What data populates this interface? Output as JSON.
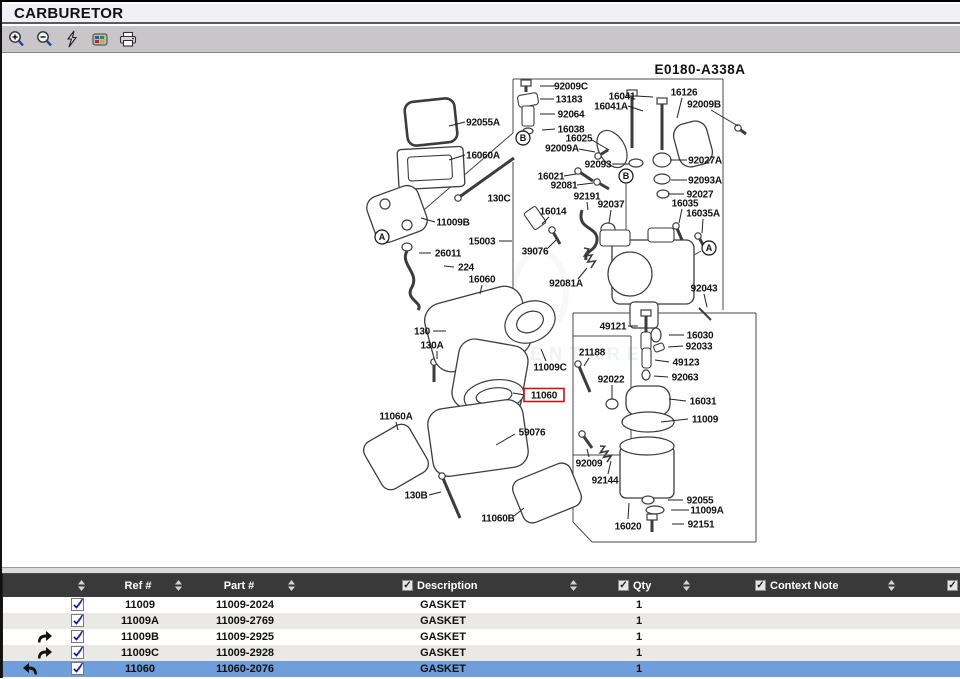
{
  "window": {
    "title": "CARBURETOR"
  },
  "toolbar": {
    "icons": [
      {
        "name": "zoom-in"
      },
      {
        "name": "zoom-out"
      },
      {
        "name": "flash"
      },
      {
        "name": "hotspot-parts"
      },
      {
        "name": "print"
      }
    ]
  },
  "colors": {
    "selected_row": "#6f9edb",
    "table_header_bg": "#3a393a",
    "row_alt": "#eae9e5",
    "toolbar_bg": "#c9c6c9",
    "titlebar_bg": "#f1f0f5",
    "highlight_red": "#cc1111"
  },
  "diagram": {
    "code": "E0180-A338A",
    "code_pos": [
      700,
      68
    ],
    "watermark": "LEADVENTURE",
    "highlighted_part": "11060",
    "callouts": [
      {
        "letter": "B",
        "x": 523,
        "y": 136
      },
      {
        "letter": "B",
        "x": 626,
        "y": 174
      },
      {
        "letter": "A",
        "x": 382,
        "y": 235
      },
      {
        "letter": "A",
        "x": 709,
        "y": 246
      }
    ],
    "labels": [
      {
        "t": "92055A",
        "x": 483,
        "y": 120,
        "ld": [
          465,
          120,
          449,
          124
        ]
      },
      {
        "t": "16060A",
        "x": 483,
        "y": 153,
        "ld": [
          465,
          153,
          449,
          158
        ]
      },
      {
        "t": "130C",
        "x": 499,
        "y": 196
      },
      {
        "t": "11009B",
        "x": 453,
        "y": 220,
        "ld": [
          435,
          220,
          421,
          216
        ]
      },
      {
        "t": "15003",
        "x": 482,
        "y": 239,
        "ld": [
          499,
          239,
          512,
          239
        ]
      },
      {
        "t": "26011",
        "x": 448,
        "y": 251,
        "ld": [
          431,
          251,
          419,
          251
        ]
      },
      {
        "t": "224",
        "x": 466,
        "y": 265,
        "ld": [
          454,
          265,
          444,
          264
        ]
      },
      {
        "t": "16060",
        "x": 482,
        "y": 277,
        "ld": [
          482,
          283,
          480,
          292
        ]
      },
      {
        "t": "130",
        "x": 422,
        "y": 329,
        "ld": [
          433,
          329,
          446,
          329
        ]
      },
      {
        "t": "130A",
        "x": 432,
        "y": 343,
        "ld": [
          437,
          349,
          437,
          357
        ]
      },
      {
        "t": "11060A",
        "x": 396,
        "y": 414,
        "ld": [
          396,
          420,
          398,
          428
        ]
      },
      {
        "t": "130B",
        "x": 416,
        "y": 493,
        "ld": [
          429,
          493,
          441,
          490
        ]
      },
      {
        "t": "11060B",
        "x": 498,
        "y": 516,
        "ld": [
          514,
          514,
          524,
          506
        ]
      },
      {
        "t": "59076",
        "x": 532,
        "y": 430,
        "ld": [
          515,
          432,
          496,
          443
        ]
      },
      {
        "t": "11060",
        "x": 544,
        "y": 393,
        "hl": true,
        "ld": [
          525,
          393,
          513,
          391
        ]
      },
      {
        "t": "11009C",
        "x": 550,
        "y": 365,
        "ld": [
          546,
          359,
          541,
          347
        ]
      },
      {
        "t": "92009C",
        "x": 571,
        "y": 84,
        "ld": [
          555,
          84,
          540,
          84
        ]
      },
      {
        "t": "13183",
        "x": 569,
        "y": 97,
        "ld": [
          554,
          97,
          540,
          97
        ]
      },
      {
        "t": "92064",
        "x": 571,
        "y": 112,
        "ld": [
          555,
          112,
          540,
          112
        ]
      },
      {
        "t": "16038",
        "x": 571,
        "y": 127,
        "ld": [
          555,
          127,
          542,
          128
        ]
      },
      {
        "t": "16025",
        "x": 579,
        "y": 136,
        "ld": [
          592,
          138,
          609,
          148
        ]
      },
      {
        "t": "92009A",
        "x": 562,
        "y": 146,
        "ld": [
          579,
          147,
          595,
          150
        ]
      },
      {
        "t": "16041",
        "x": 622,
        "y": 94,
        "ld": [
          636,
          94,
          653,
          95
        ]
      },
      {
        "t": "16041A",
        "x": 611,
        "y": 104,
        "ld": [
          628,
          104,
          643,
          109
        ]
      },
      {
        "t": "16126",
        "x": 684,
        "y": 90,
        "ld": [
          682,
          96,
          677,
          116
        ]
      },
      {
        "t": "92009B",
        "x": 704,
        "y": 102,
        "ld": [
          711,
          108,
          738,
          124
        ]
      },
      {
        "t": "92093",
        "x": 598,
        "y": 162,
        "ld": [
          612,
          162,
          629,
          162
        ]
      },
      {
        "t": "16021",
        "x": 551,
        "y": 174,
        "ld": [
          564,
          174,
          576,
          172
        ]
      },
      {
        "t": "92081",
        "x": 564,
        "y": 183,
        "ld": [
          577,
          183,
          593,
          181
        ]
      },
      {
        "t": "92191",
        "x": 587,
        "y": 194,
        "ld": [
          587,
          200,
          588,
          208
        ]
      },
      {
        "t": "92037",
        "x": 611,
        "y": 202,
        "ld": [
          611,
          208,
          609,
          221
        ]
      },
      {
        "t": "16014",
        "x": 553,
        "y": 209,
        "ld": [
          549,
          215,
          542,
          222
        ]
      },
      {
        "t": "39076",
        "x": 535,
        "y": 249,
        "ld": [
          548,
          246,
          556,
          238
        ]
      },
      {
        "t": "92081A",
        "x": 566,
        "y": 281,
        "ld": [
          578,
          277,
          587,
          266
        ]
      },
      {
        "t": "92027A",
        "x": 705,
        "y": 158,
        "ld": [
          687,
          158,
          670,
          158
        ]
      },
      {
        "t": "92093A",
        "x": 705,
        "y": 178,
        "ld": [
          687,
          178,
          671,
          178
        ]
      },
      {
        "t": "92027",
        "x": 700,
        "y": 192,
        "ld": [
          684,
          192,
          668,
          192
        ]
      },
      {
        "t": "16035",
        "x": 685,
        "y": 201,
        "ld": [
          682,
          207,
          679,
          221
        ]
      },
      {
        "t": "16035A",
        "x": 703,
        "y": 211,
        "ld": [
          703,
          217,
          702,
          231
        ]
      },
      {
        "t": "92043",
        "x": 704,
        "y": 286,
        "ld": [
          704,
          292,
          707,
          305
        ]
      },
      {
        "t": "49121",
        "x": 613,
        "y": 324,
        "ld": [
          628,
          324,
          638,
          324
        ]
      },
      {
        "t": "16030",
        "x": 700,
        "y": 333,
        "ld": [
          684,
          333,
          669,
          333
        ]
      },
      {
        "t": "92033",
        "x": 699,
        "y": 344,
        "ld": [
          683,
          344,
          668,
          345
        ]
      },
      {
        "t": "49123",
        "x": 686,
        "y": 360,
        "ld": [
          669,
          360,
          655,
          358
        ]
      },
      {
        "t": "92063",
        "x": 685,
        "y": 375,
        "ld": [
          668,
          375,
          654,
          374
        ]
      },
      {
        "t": "16031",
        "x": 703,
        "y": 399,
        "ld": [
          686,
          399,
          669,
          397
        ]
      },
      {
        "t": "11009",
        "x": 705,
        "y": 417,
        "ld": [
          688,
          417,
          661,
          420
        ]
      },
      {
        "t": "21188",
        "x": 592,
        "y": 350,
        "ld": [
          589,
          356,
          584,
          364
        ]
      },
      {
        "t": "92022",
        "x": 611,
        "y": 377,
        "ld": [
          612,
          383,
          612,
          397
        ]
      },
      {
        "t": "92009",
        "x": 589,
        "y": 461,
        "ld": [
          589,
          455,
          587,
          447
        ]
      },
      {
        "t": "92144",
        "x": 605,
        "y": 478,
        "ld": [
          608,
          472,
          611,
          459
        ]
      },
      {
        "t": "92055",
        "x": 700,
        "y": 498,
        "ld": [
          683,
          498,
          668,
          498
        ]
      },
      {
        "t": "11009A",
        "x": 707,
        "y": 508,
        "ld": [
          689,
          508,
          671,
          508
        ]
      },
      {
        "t": "92151",
        "x": 701,
        "y": 522,
        "ld": [
          684,
          522,
          672,
          522
        ]
      },
      {
        "t": "16020",
        "x": 628,
        "y": 524,
        "ld": [
          628,
          517,
          629,
          501
        ]
      }
    ],
    "outlines": [
      [
        513,
        77,
        723,
        77
      ],
      [
        513,
        77,
        513,
        131
      ],
      [
        513,
        131,
        388,
        239
      ],
      [
        723,
        77,
        723,
        308
      ],
      [
        513,
        160,
        513,
        311
      ],
      [
        573,
        311,
        756,
        311
      ],
      [
        756,
        311,
        756,
        540
      ],
      [
        756,
        540,
        592,
        540
      ],
      [
        592,
        540,
        573,
        520
      ],
      [
        573,
        520,
        573,
        311
      ],
      [
        573,
        334,
        631,
        334
      ],
      [
        631,
        334,
        631,
        453
      ],
      [
        573,
        453,
        631,
        453
      ],
      [
        626,
        182,
        626,
        236
      ],
      [
        389,
        230,
        413,
        208
      ],
      [
        701,
        249,
        687,
        257
      ]
    ],
    "shapes": [
      [
        "rr",
        406,
        98,
        50,
        44,
        9,
        -6,
        2.6,
        "none"
      ],
      [
        "rr",
        398,
        146,
        66,
        40,
        4,
        -3,
        1.3,
        "#fff"
      ],
      [
        "rr",
        408,
        154,
        44,
        24,
        3,
        -3,
        1.1,
        "none"
      ],
      [
        "rr",
        370,
        188,
        54,
        48,
        12,
        -20,
        1.3,
        "#fff"
      ],
      [
        "el",
        385,
        202,
        5,
        5,
        0
      ],
      [
        "el",
        407,
        223,
        5,
        5,
        0
      ],
      [
        "scr",
        458,
        196,
        514,
        156
      ],
      [
        "pa",
        "M408,247 C398,262 420,270 412,285 C404,298 424,300 418,308"
      ],
      [
        "el",
        407,
        245,
        5,
        4,
        0
      ],
      [
        "scr",
        449,
        330,
        449,
        352
      ],
      [
        "scr",
        434,
        360,
        434,
        380
      ],
      [
        "rr",
        428,
        292,
        100,
        70,
        18,
        -15,
        1.3,
        "#fff"
      ],
      [
        "rr",
        455,
        340,
        70,
        70,
        16,
        10,
        1.3,
        "#fff"
      ],
      [
        "el",
        530,
        320,
        26,
        20,
        -25
      ],
      [
        "el",
        530,
        320,
        14,
        10,
        -25
      ],
      [
        "el",
        494,
        394,
        30,
        16,
        -8
      ],
      [
        "el",
        494,
        394,
        18,
        8,
        -8
      ],
      [
        "rr",
        430,
        402,
        96,
        68,
        16,
        -8,
        1.3,
        "#fff"
      ],
      [
        "rr",
        370,
        428,
        52,
        54,
        10,
        -30,
        1.3,
        "#fff"
      ],
      [
        "rr",
        516,
        468,
        62,
        46,
        10,
        -22,
        1.3,
        "#fff"
      ],
      [
        "scr",
        442,
        474,
        460,
        516
      ],
      [
        "blt",
        526,
        78,
        12
      ],
      [
        "rr",
        518,
        92,
        20,
        12,
        3,
        -10,
        1.1,
        "#fff"
      ],
      [
        "rr",
        522,
        104,
        12,
        20,
        2,
        0,
        1.1,
        "#fff"
      ],
      [
        "el",
        528,
        129,
        5,
        3,
        0
      ],
      [
        "el",
        612,
        147,
        13,
        20,
        -30
      ],
      [
        "scr",
        598,
        154,
        608,
        148
      ],
      [
        "blt",
        662,
        96,
        52
      ],
      [
        "blt",
        632,
        88,
        58
      ],
      [
        "rr",
        676,
        120,
        34,
        44,
        12,
        -15,
        1.3,
        "#fff"
      ],
      [
        "scr",
        738,
        126,
        746,
        132
      ],
      [
        "el",
        636,
        161,
        7,
        4,
        0
      ],
      [
        "el",
        662,
        158,
        9,
        7,
        0
      ],
      [
        "el",
        662,
        177,
        8,
        5,
        0
      ],
      [
        "el",
        663,
        192,
        6,
        4,
        0
      ],
      [
        "scr",
        578,
        169,
        593,
        179
      ],
      [
        "scr",
        597,
        180,
        609,
        187
      ],
      [
        "pa",
        "M582,208 C576,228 598,224 597,238 C596,250 584,248 586,258"
      ],
      [
        "el",
        608,
        227,
        7,
        6,
        0
      ],
      [
        "rr",
        528,
        206,
        14,
        20,
        2,
        -35,
        1.1,
        "#fff"
      ],
      [
        "scr",
        552,
        228,
        560,
        242
      ],
      [
        "coil",
        584,
        246,
        594,
        264
      ],
      [
        "scr",
        676,
        224,
        682,
        238
      ],
      [
        "scr",
        698,
        234,
        705,
        246
      ],
      [
        "ln",
        699,
        306,
        711,
        318,
        2
      ],
      [
        "rr",
        612,
        238,
        82,
        64,
        8,
        0,
        1.3,
        "#fff"
      ],
      [
        "el",
        630,
        272,
        22,
        22,
        0
      ],
      [
        "rr",
        630,
        300,
        28,
        26,
        4,
        0,
        1.2,
        "#fff"
      ],
      [
        "rr",
        600,
        228,
        30,
        16,
        3,
        0,
        1.1,
        "#fff"
      ],
      [
        "rr",
        648,
        226,
        26,
        14,
        3,
        0,
        1.1,
        "#fff"
      ],
      [
        "blt",
        646,
        308,
        24
      ],
      [
        "rr",
        641,
        330,
        10,
        18,
        3,
        0,
        1.1,
        "#fff"
      ],
      [
        "el",
        656,
        333,
        5,
        7,
        0
      ],
      [
        "rr",
        654,
        342,
        10,
        7,
        2,
        -20,
        1.1,
        "#fff"
      ],
      [
        "rr",
        642,
        346,
        9,
        20,
        3,
        0,
        1.1,
        "#fff"
      ],
      [
        "el",
        646,
        373,
        4,
        5,
        0
      ],
      [
        "rr",
        626,
        384,
        44,
        30,
        12,
        0,
        1.3,
        "#fff"
      ],
      [
        "el",
        648,
        420,
        26,
        10,
        0
      ],
      [
        "scr",
        578,
        362,
        590,
        390
      ],
      [
        "el",
        612,
        402,
        6,
        5,
        0
      ],
      [
        "scr",
        582,
        432,
        592,
        446
      ],
      [
        "coil",
        600,
        444,
        610,
        458
      ],
      [
        "rr",
        620,
        444,
        54,
        52,
        6,
        0,
        1.3,
        "#fff"
      ],
      [
        "el",
        647,
        444,
        27,
        9,
        0
      ],
      [
        "el",
        648,
        498,
        6,
        4,
        0
      ],
      [
        "el",
        655,
        508,
        9,
        4,
        0
      ],
      [
        "blt",
        652,
        512,
        18
      ]
    ]
  },
  "table": {
    "columns": [
      "Ref #",
      "Part #",
      "Description",
      "Qty",
      "Context Note"
    ],
    "checked_columns": [
      "Description",
      "Qty",
      "Context Note"
    ],
    "rows": [
      {
        "arrow": "",
        "ref": "11009",
        "part": "11009-2024",
        "desc": "GASKET",
        "qty": "1",
        "note": "",
        "selected": false
      },
      {
        "arrow": "",
        "ref": "11009A",
        "part": "11009-2769",
        "desc": "GASKET",
        "qty": "1",
        "note": "",
        "selected": false
      },
      {
        "arrow": "forward",
        "ref": "11009B",
        "part": "11009-2925",
        "desc": "GASKET",
        "qty": "1",
        "note": "",
        "selected": false
      },
      {
        "arrow": "forward",
        "ref": "11009C",
        "part": "11009-2928",
        "desc": "GASKET",
        "qty": "1",
        "note": "",
        "selected": false
      },
      {
        "arrow": "back",
        "ref": "11060",
        "part": "11060-2076",
        "desc": "GASKET",
        "qty": "1",
        "note": "",
        "selected": true
      }
    ]
  }
}
